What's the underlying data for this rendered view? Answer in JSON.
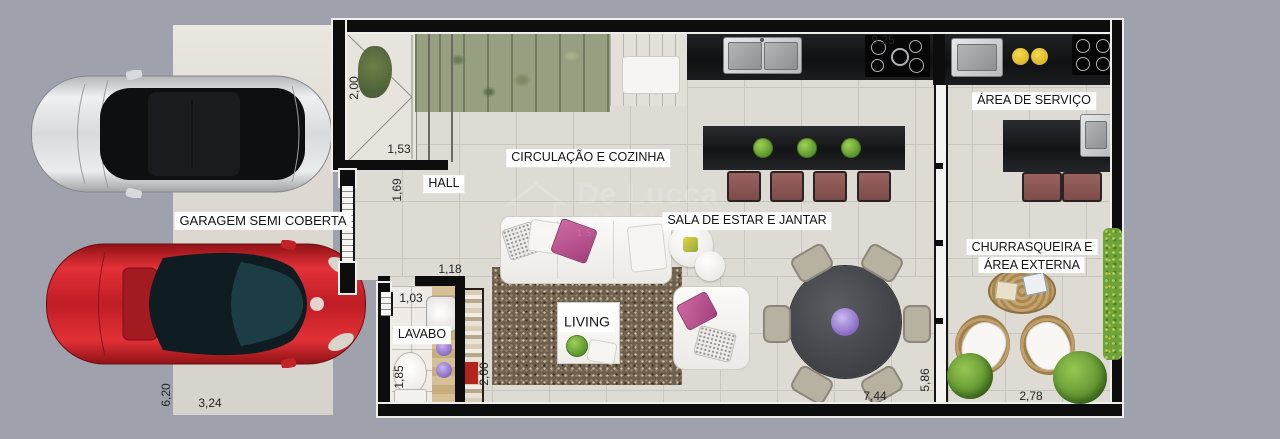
{
  "scene": {
    "type": "floor-plan-render",
    "background_color": "#9fa1ac"
  },
  "rooms": {
    "garagem": {
      "label": "GARAGEM SEMI COBERTA"
    },
    "hall": {
      "label": "HALL"
    },
    "lavabo": {
      "label": "LAVABO"
    },
    "circulacao_cozinha": {
      "label": "CIRCULAÇÃO E COZINHA"
    },
    "sala_estar_jantar": {
      "label": "SALA DE ESTAR E JANTAR"
    },
    "living": {
      "label": "LIVING"
    },
    "area_servico": {
      "label": "ÁREA DE SERVIÇO"
    },
    "churrasqueira": {
      "line1": "CHURRASQUEIRA E",
      "line2": "ÁREA EXTERNA"
    }
  },
  "dimensions": {
    "hatch_height": "2,00",
    "cozinha_width": "9,25",
    "hatch_width": "1,53",
    "hall_wall": "1,69",
    "hall_opening": "1,18",
    "lavabo_width": "1,03",
    "lavabo_depth": "1,85",
    "living_wall": "2,00",
    "sala_width": "7,44",
    "divider_depth": "5,86",
    "externa_width": "2,78",
    "garagem_depth": "6,20",
    "garagem_width": "3,24"
  },
  "watermark": {
    "name": "De Lucca",
    "subtitle": "IMÓVEIS",
    "code": "152-J"
  },
  "colors": {
    "background": "#9fa1ac",
    "wall": "#0d0d0e",
    "floor": "#dedbd5",
    "counter": "#17181a",
    "car_red": "#c2252b",
    "car_silver": "#d7d8da",
    "stool": "#8a5552",
    "dining_table": "#4a4c50",
    "flowers_purple": "#9b80d2",
    "flowers_yellow": "#e6c327",
    "plant_green": "#6fae3f",
    "pillow_pink": "#c05a92"
  }
}
